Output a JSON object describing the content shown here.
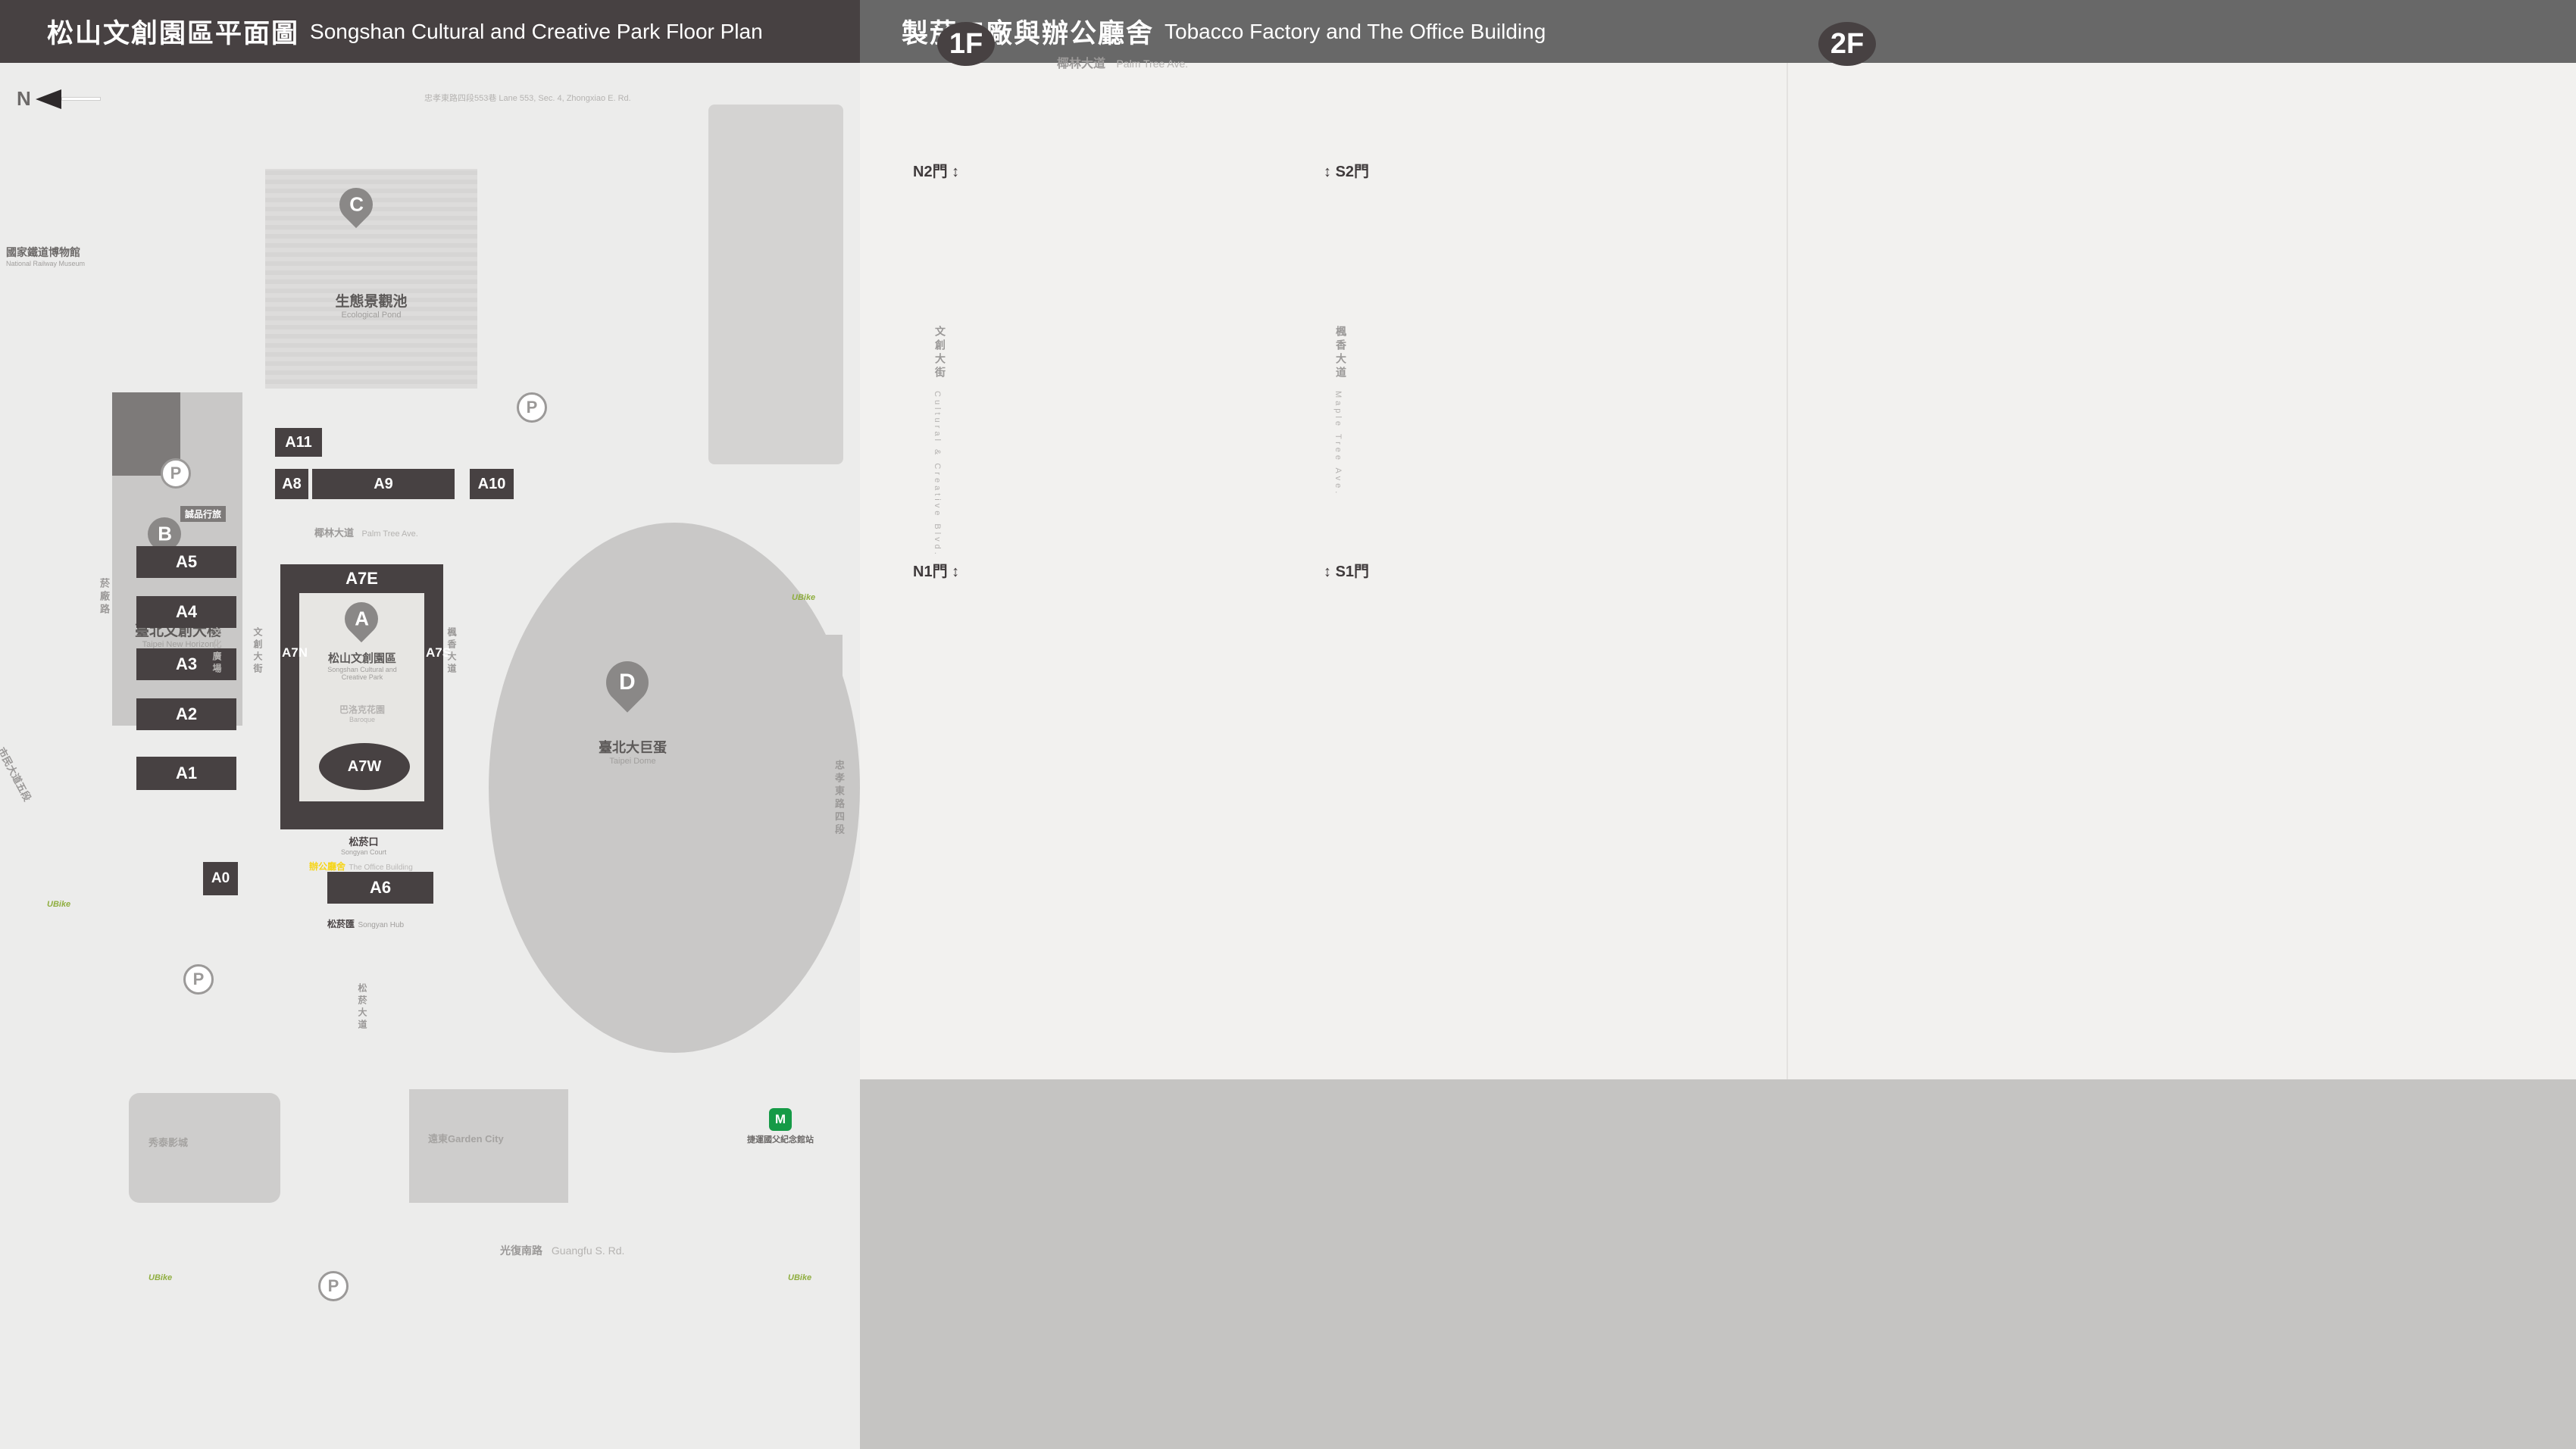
{
  "colors": {
    "dark": "#474142",
    "header_gray": "#686868",
    "panel_bg": "#ececeb",
    "right_bg": "#f2f1ef",
    "gray_band": "#c5c4c2",
    "yellow": "#f6d51b",
    "red": "#c2202d",
    "map_gray": "#cecdcc",
    "courtyard": "#e7e6e3"
  },
  "left": {
    "header": {
      "zh": "松山文創園區平面圖",
      "en": "Songshan Cultural and Creative Park Floor Plan"
    },
    "map": {
      "north": "N",
      "roads": {
        "top": "忠孝東路四段553巷 Lane 553, Sec. 4, Zhongxiao E. Rd.",
        "palm_zh": "椰林大道",
        "palm_en": "Palm Tree Ave.",
        "yanchang": "菸廠路",
        "civic": "市民大道五段",
        "guangfu_zh": "光復南路",
        "guangfu_en": "Guangfu S. Rd.",
        "zhongxiao_zh": "忠孝東路四段",
        "zhongxiao_en": "Sec. 4, Zhongxiao E. Rd.",
        "songyan_zh": "松菸大道",
        "songyan_en": "Songyan Ave.",
        "cultural_blvd_zh": "文創大街",
        "cultural_blvd_en": "Cultural & Creative Blvd.",
        "maple_zh": "楓香大道",
        "maple_en": "Maple Tree Ave.",
        "plaza_zh": "文化廣場",
        "plaza_en": "Cultural Plaza"
      },
      "places": {
        "railway_zh": "國家鐵道博物館",
        "railway_en": "National Railway Museum",
        "eslite_hotel": "誠品行旅",
        "new_horizon_zh": "臺北文創大樓",
        "new_horizon_en": "Taipei New Horizon",
        "eslite_spectrum": "誠品生活松菸",
        "pond_zh": "生態景觀池",
        "pond_en": "Ecological Pond",
        "park_zh": "松山文創園區",
        "park_en1": "Songshan Cultural and",
        "park_en2": "Creative Park",
        "baroque_zh": "巴洛克花園",
        "baroque_en1": "Baroque",
        "baroque_en2": "Garden",
        "court_zh": "松菸口",
        "court_en": "Songyan Court",
        "office_zh": "辦公廳舍",
        "office_en": "The Office Building",
        "hub_zh": "松菸匯",
        "hub_en": "Songyan Hub",
        "dome_zh": "臺北大巨蛋",
        "dome_en": "Taipei Dome",
        "hotel": "臺北洲際酒店",
        "dome_center": "巨蛋國際中心",
        "showtimes": "秀泰影城",
        "garden_city": "遠東Garden City",
        "mrt": "捷運國父紀念館站",
        "ubike": "UBike",
        "parking": "P"
      },
      "buildings": {
        "a11": "A11",
        "a8": "A8",
        "a9": "A9",
        "a10": "A10",
        "a7e": "A7E",
        "a7n": "A7N",
        "a7s": "A7S",
        "a7w": "A7W",
        "a6": "A6",
        "a5": "A5",
        "a4": "A4",
        "a3": "A3",
        "a2": "A2",
        "a1": "A1",
        "a0": "A0",
        "a": "A"
      },
      "entrances": [
        "1",
        "2",
        "3",
        "4",
        "5",
        "6",
        "7",
        "8",
        "9",
        "10",
        "11",
        "12"
      ]
    },
    "legend": {
      "landmarks": [
        {
          "key": "N",
          "zh": "園區入口",
          "en": "Entrance"
        },
        {
          "key": "A",
          "zh": "松山文創園區",
          "en": "Songshan Cultural\nand Creative Park"
        },
        {
          "key": "B",
          "zh": "臺北文創大樓",
          "en": "Taipei New Horizon"
        },
        {
          "key": "C",
          "zh": "生態景觀池",
          "en": "Ecological Pond"
        },
        {
          "key": "D",
          "zh": "臺北大巨蛋",
          "en": "Taipei Dome"
        }
      ],
      "buildings_a": [
        {
          "code": "A0",
          "zh": "檢查室",
          "en": "Inspection Room",
          "icons": []
        },
        {
          "code": "A1",
          "zh": "1號倉庫",
          "en": "Warehouse No. 1",
          "icons": [
            "locker",
            "toilet"
          ]
        },
        {
          "code": "A2",
          "zh": "2號倉庫",
          "en": "Warehouse No. 2",
          "icons": [
            "aed"
          ]
        },
        {
          "code": "A3",
          "zh": "3號倉庫",
          "en": "Warehouse No. 3",
          "icons": []
        },
        {
          "code": "A4",
          "zh": "4號倉庫",
          "en": "Warehouse No. 4",
          "icons": []
        },
        {
          "code": "A5",
          "zh": "5號倉庫",
          "en": "Warehouse No. 5",
          "icons": []
        },
        {
          "code": "A6",
          "zh": "辦公廳舍",
          "en": "The Office Building",
          "icons": [
            "aed",
            "toilet",
            "fnb",
            "info"
          ]
        }
      ],
      "buildings_b": [
        {
          "code": "A7 E",
          "zh": "製菸工廠|東向",
          "en": "East Tobacco Factory",
          "icons": [
            "aed",
            "toilet",
            "fnb"
          ]
        },
        {
          "code": "A7 W",
          "zh": "製菸工廠|西向",
          "en": "West Tobacco Factory",
          "icons": [
            "nursing",
            "toilet"
          ]
        },
        {
          "code": "A7 S",
          "zh": "製菸工廠|南向",
          "en": "South Tobacco Factory",
          "icons": [
            "toilet"
          ]
        },
        {
          "code": "A7 N",
          "zh": "製菸工廠|北向",
          "en": "North Tobacco Factory",
          "icons": [
            "toilet"
          ]
        },
        {
          "code": "A8",
          "zh": "全家便利商店",
          "en": "FamilyMart",
          "icons": [
            "locker",
            "aed",
            "fnb"
          ]
        },
        {
          "code": "A9",
          "zh": "機器修理廠",
          "brand": "ISLAND133 gonna'",
          "brand_sub": "ISLAND133 gonna'",
          "en": "The Machine Repair Plant",
          "icons": [
            "fnb"
          ]
        },
        {
          "code": "A10",
          "zh": "鍋爐房",
          "brand": "豆留文青",
          "brand_sub": "CAMA COFFEE ROASTERS",
          "en": "Boiler Room",
          "icons": [
            "fnb"
          ]
        },
        {
          "code": "A11",
          "zh": "育嬰室",
          "brand": "光一 一個時間",
          "brand_sub": "GUANG YIN TIME",
          "en": "The Nursery Room",
          "icons": [
            "fnb"
          ]
        }
      ]
    }
  },
  "right": {
    "header": {
      "zh": "製菸工廠與辦公廳舍",
      "en": "Tobacco Factory and The Office Building"
    },
    "floor1": {
      "badge": "1F",
      "street_zh": "椰林大道",
      "street_en": "Palm Tree Ave.",
      "plan": {
        "center_zh": "A7 製菸工廠",
        "garden_zh": "巴洛克花園",
        "garden_en1": "Baroque",
        "garden_en2": "Garden",
        "doors": {
          "n2": "N2門",
          "s2": "S2門",
          "n1": "N1門",
          "s1": "S1門"
        },
        "left_street_zh": "文創大街",
        "left_street_en": "Cultural & Creative Blvd.",
        "right_street_zh": "楓香大道",
        "right_street_en": "Maple Tree Ave.",
        "rooms_top": [
          "E101",
          "E102",
          "E103"
        ],
        "rooms_left": [
          "N101"
        ],
        "rooms_right": [
          "S104",
          "S103",
          "S102",
          "S101"
        ],
        "rooms_bottom": [
          "W102",
          "W103",
          "W107",
          "W108",
          "W109",
          "W110",
          "W111",
          "W104",
          "W116",
          "W101",
          "W115",
          "W113"
        ]
      },
      "sections": {
        "a7e1": {
          "box": "A7 E",
          "zh": "製菸工廠|東向",
          "en": "East Tobacco Factory",
          "rows": [
            {
              "code": "E101",
              "zh": "小智研發垃圾廚坊",
              "en": "MINIWIZ Trash Kitchen"
            },
            {
              "code": "E103",
              "zh": "松菸風格店家",
              "en": "Songyan Style Gallery",
              "icon": "fnb"
            }
          ]
        },
        "a7w1": {
          "box": "A7 W",
          "zh": "製菸工廠|西向",
          "en": "West Tobacco Factory",
          "rows": [
            {
              "code": "W101–103",
              "code2": "W107.W115",
              "zh": "台灣設計館",
              "en": "Taiwan Design Museum"
            },
            {
              "code": "W104",
              "zh": "不只是圖書館",
              "en": "Not Just Library"
            },
            {
              "code": "W108",
              "zh": "谷口写真企画室",
              "en": "no photo no life"
            },
            {
              "code": "W109",
              "zh": "以覺學",
              "en": "INTZUITION"
            },
            {
              "code": "W110",
              "zh": "TAIWANIZE",
              "en": ""
            },
            {
              "code": "W111",
              "zh": "藝巷空間|醫護室",
              "en": "Art Space D | Clinic"
            },
            {
              "code": "W113",
              "zh": "炊事場|eyecandle",
              "en": "Catering Room | eyecandle"
            },
            {
              "code": "W116",
              "zh": "男澡堂",
              "en": "Male Bathhouse"
            }
          ]
        },
        "a7s1": {
          "box": "A7 S",
          "zh": "製菸工廠|南向",
          "en": "South Tobacco Factory",
          "rows": [
            {
              "code": "S101",
              "zh": "藝思空間",
              "en": "Art Space B"
            },
            {
              "code": "S102",
              "zh": "原樂好市–原民主題選品店",
              "en": "One Love Taipei–Indigenous Concept Store"
            },
            {
              "code": "S103",
              "zh": "藝異空間",
              "en": "Art Space A"
            },
            {
              "code": "S104",
              "zh": "南向製菸工廠",
              "en": "South Tobacco Factory"
            }
          ]
        },
        "a7n1": {
          "box": "A7 N",
          "zh": "製菸工廠|北向",
          "en": "North Tobacco Factory",
          "rows": [
            {
              "code": "N101",
              "zh": "北向製菸工廠",
              "en": "North Tobacco Factory"
            }
          ]
        }
      },
      "court": {
        "zh": "松菸口",
        "en": "Songyan Court",
        "title1": "臺北文化小旅行",
        "title2": "（松山菸廠廠歌石碑）",
        "en1": "Mini Cultural Trips in Taipei",
        "en2": "(Stone Tablet of Songshan Tobacco Factory Anthem)"
      }
    },
    "office1": {
      "plan_title": "A6 辦公廳舍",
      "court_zh": "松菸口",
      "court_en": "Songyan Court",
      "hub_zh": "松菸匯",
      "hub_en": "Songyan Hub",
      "rooms": [
        "O104",
        "O108",
        "O103",
        "O102",
        "O110",
        "O109"
      ],
      "box": "A6",
      "zh": "辦公廳舍 1F",
      "en": "The Office Building",
      "rows": [
        {
          "code": "O102",
          "zh": "台灣設計館售票處",
          "en": "Taiwan Design Museum Ticket Counter"
        },
        {
          "code": "O103–104",
          "zh": "設計點",
          "en": "Design Pin"
        },
        {
          "code": "O108",
          "zh": "hof (EVERYDAY OBJECT)",
          "en": "",
          "icon": "fnb"
        },
        {
          "code": "O109",
          "zh": "松菸匯 辦公廳舍創意空間",
          "en": "Songyan Hub, SCCP Creative Space"
        },
        {
          "code": "O110",
          "zh": "松菸匯 松山文創園區服務中心",
          "en": "Songyan Hub, SCCP Information Center"
        }
      ]
    },
    "floor2": {
      "badge": "2F",
      "plan": {
        "center_zh": "A7 製菸工廠",
        "rooms_top": [
          "E201",
          "E202",
          "E203"
        ],
        "rooms_left": [
          "N202",
          "N201"
        ],
        "rooms_right": [
          "S203",
          "S201"
        ],
        "rooms_bottom": [
          "W204",
          "W205",
          "W206",
          "W207",
          "W208",
          "W210"
        ]
      },
      "sections": {
        "a7e2": {
          "box": "A7 E",
          "zh": "製菸工廠|東向",
          "en": "East Tobacco Factory",
          "rows": [
            {
              "code": "E201",
              "zh": "藝趣空間",
              "en": "Art Space C"
            },
            {
              "code": "E202",
              "zh": "文創交流中心",
              "en": "Exchange Center"
            },
            {
              "code": "E203",
              "zh": "XR沉浸玩家",
              "en": "XR PLAYHOUSE"
            }
          ]
        },
        "a7w2": {
          "box": "A7 W",
          "zh": "製菸工廠|西向",
          "en": "West Tobacco Factory",
          "rows": [
            {
              "code": "W204–206",
              "zh": "多功能展演廳",
              "en": "Multi–Purpose Hall"
            },
            {
              "code": "W207",
              "zh": "iF台北設計沙龍 / 藝符設計",
              "en": "iF Design Salon Taipei / iF DESIGN ASIA"
            },
            {
              "code": "W210",
              "zh": "松山文創園區營運中心",
              "zh2": "西向會議室",
              "en": "West Meeting Room SCCP"
            }
          ]
        },
        "a7s2": {
          "box": "A7 S",
          "zh": "製菸工廠|南向",
          "en": "South Tobacco Factory",
          "rows": [
            {
              "code": "S201",
              "zh": "台灣設計聯盟",
              "en": "Taiwan Design Alliance"
            },
            {
              "code": "S203",
              "zh": "松菸創作者工廠",
              "en": "Songyan Creative Hub"
            }
          ]
        },
        "a7n2": {
          "box": "A7 N",
          "zh": "製菸工廠|北向",
          "en": "North Tobacco Factory",
          "rows": [
            {
              "code": "N201",
              "zh": "台灣設計研究院 服務台",
              "en": "TDRI Information"
            },
            {
              "code": "N202",
              "zh": "台灣設計研究院 創意劇場",
              "en": "TDRI Creative Forum"
            }
          ]
        }
      }
    },
    "office2": {
      "plan_title": "A6 辦公廳舍",
      "rooms": [
        "O204",
        "O205",
        "O203",
        "O202",
        "O207",
        "O206"
      ],
      "box": "A6",
      "zh": "辦公廳舍 2F",
      "en": "The Office Building",
      "rows": [
        {
          "code": "O202",
          "zh": "松山文創園區營運中心202會議室",
          "en": "Meeting Room SCCP 202"
        },
        {
          "code": "O203",
          "zh": "台灣設計研究院201會議室",
          "en": "Meeting Room TDRI 201"
        },
        {
          "code": "O204",
          "zh": "台灣設計研究院202會議室",
          "en": "Meeting Room TDRI 202"
        },
        {
          "code": "O205",
          "zh": "松山文創園區營運中心201會議室",
          "en": "Meeting Room SCCP 201"
        },
        {
          "code": "O206–207",
          "zh": "台北市文化基金會",
          "zh2": "松山文創園區營運中心",
          "en": "Taipei Culture Foundation SCCP Management Center"
        },
        {
          "code": "O302",
          "prefix": "3F",
          "zh": "松山文創園區營運中心301會議室",
          "en": "Meeting Room SCCP 301"
        }
      ]
    }
  },
  "facilities": [
    {
      "id": "info",
      "zh": "服務中心",
      "en": "Information"
    },
    {
      "id": "audio",
      "zh": "語音導覽",
      "en": "Audio Tour"
    },
    {
      "id": "fnb",
      "zh": "飲食",
      "en": "F&B"
    },
    {
      "id": "smoking",
      "zh": "吸菸區",
      "en": "Smoking Area"
    },
    {
      "id": "water",
      "zh": "飲水機",
      "en": "Drinking Fountain"
    },
    {
      "id": "aed",
      "zh": "緊急心臟除顫器",
      "en": "AED"
    },
    {
      "id": "locker",
      "zh": "置物櫃",
      "en": "Baggage Lockers"
    },
    {
      "id": "toilet",
      "zh": "廁所",
      "en": "Toilet"
    },
    {
      "id": "allgender",
      "zh": "性別友善廁所",
      "en": "All Gender Toilet"
    },
    {
      "id": "men",
      "zh": "男廁",
      "en": "Men's Toilet"
    },
    {
      "id": "women",
      "zh": "女廁",
      "en": "Women's Toilet"
    },
    {
      "id": "accessible",
      "zh": "無障礙廁所",
      "en": "Accessible Toilet"
    },
    {
      "id": "nursing",
      "zh": "哺集乳室",
      "en": "Breastfeeding Room"
    },
    {
      "id": "powerbank",
      "zh": "共享行動電源",
      "en": "Power Bank Rental"
    },
    {
      "id": "umbrella",
      "zh": "共享傘",
      "en": "Umbrella Rental"
    },
    {
      "id": "stairs",
      "zh": "階梯",
      "en": "Stairs"
    },
    {
      "id": "freight",
      "zh": "貨梯",
      "en": "Elevator For Goods"
    },
    {
      "id": "elevator",
      "zh": "無障礙電梯",
      "en": "Accessible Elevator"
    },
    {
      "id": "walk",
      "zh": "臺北文化小旅行（松山菸廠廠歌石碑）",
      "en1": "Mini Cultural Trips in Taipei",
      "en2": "(Stone Tablet of Songshan Tobacco Factory Anthem)"
    }
  ]
}
